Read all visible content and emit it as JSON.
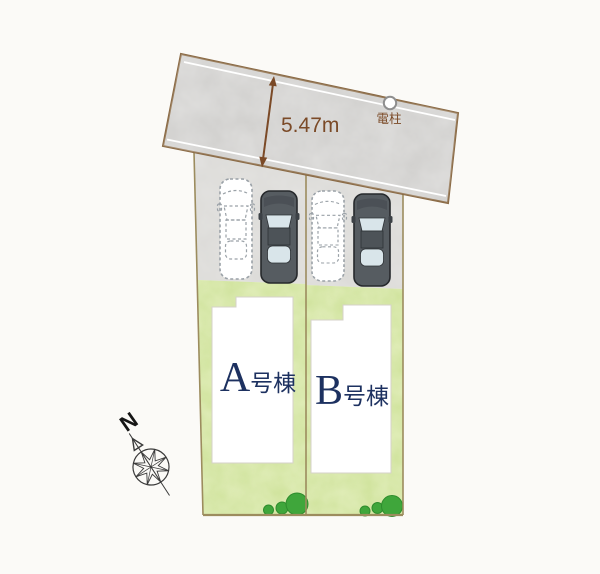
{
  "plan": {
    "road": {
      "width_label": "5.47m",
      "utility_pole_label": "電柱"
    },
    "lots": [
      {
        "letter": "A",
        "suffix": "号棟"
      },
      {
        "letter": "B",
        "suffix": "号棟"
      }
    ],
    "compass": {
      "north_label": "N"
    },
    "colors": {
      "background": "#fbfaf7",
      "road_fill": "#d0cfcd",
      "road_border": "#8a6a45",
      "road_line": "#ffffff",
      "parking_fill": "#dbdad7",
      "grass_fill": "#cee29a",
      "lot_border": "#9c8c5e",
      "dimension": "#7b4a27",
      "building_fill": "#ffffff",
      "building_border": "#d5d2c9",
      "label_text": "#1d3160",
      "pole_border": "#8f8f8f",
      "bush": "#3fa63b",
      "bush_dark": "#2e8c2d",
      "car_dark": "#565c61",
      "car_dark_stroke": "#26292c",
      "car_glass": "#d9e5ea",
      "car_ghost_stroke": "#9aa1a7",
      "compass_stroke": "#3a3a3a"
    }
  }
}
